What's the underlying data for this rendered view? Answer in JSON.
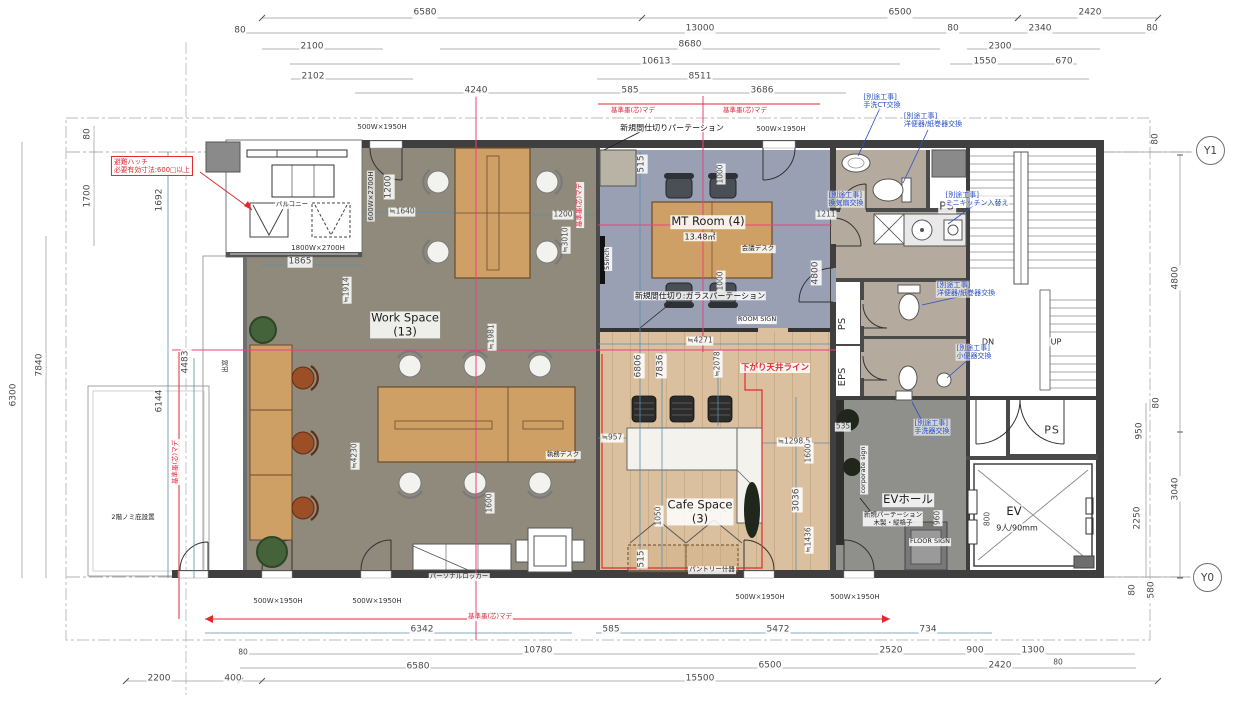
{
  "grid": {
    "y1": "Y1",
    "y0": "Y0"
  },
  "labels": {
    "dims_top": [
      {
        "t": "6580",
        "x": 425,
        "y": 13,
        "c": "dim"
      },
      {
        "t": "13000",
        "x": 700,
        "y": 29,
        "c": "dim"
      },
      {
        "t": "6500",
        "x": 900,
        "y": 13,
        "c": "dim"
      },
      {
        "t": "2420",
        "x": 1090,
        "y": 13,
        "c": "dim"
      },
      {
        "t": "80",
        "x": 240,
        "y": 31,
        "c": "dim"
      },
      {
        "t": "80",
        "x": 953,
        "y": 29,
        "c": "dim"
      },
      {
        "t": "2340",
        "x": 1040,
        "y": 29,
        "c": "dim"
      },
      {
        "t": "80",
        "x": 1152,
        "y": 29,
        "c": "dim"
      },
      {
        "t": "2100",
        "x": 312,
        "y": 47,
        "c": "dim"
      },
      {
        "t": "8680",
        "x": 690,
        "y": 45,
        "c": "dim"
      },
      {
        "t": "2300",
        "x": 1000,
        "y": 47,
        "c": "dim"
      },
      {
        "t": "10613",
        "x": 656,
        "y": 62,
        "c": "dim"
      },
      {
        "t": "1550",
        "x": 985,
        "y": 62,
        "c": "dim"
      },
      {
        "t": "670",
        "x": 1064,
        "y": 62,
        "c": "dim"
      },
      {
        "t": "2102",
        "x": 313,
        "y": 77,
        "c": "dim"
      },
      {
        "t": "8511",
        "x": 700,
        "y": 77,
        "c": "dim"
      },
      {
        "t": "4240",
        "x": 476,
        "y": 91,
        "c": "dim"
      },
      {
        "t": "585",
        "x": 630,
        "y": 91,
        "c": "dim"
      },
      {
        "t": "3686",
        "x": 762,
        "y": 91,
        "c": "dim"
      }
    ],
    "dims_bottom": [
      {
        "t": "6342",
        "x": 422,
        "y": 630,
        "c": "dim"
      },
      {
        "t": "585",
        "x": 611,
        "y": 630,
        "c": "dim"
      },
      {
        "t": "5472",
        "x": 778,
        "y": 630,
        "c": "dim"
      },
      {
        "t": "734",
        "x": 928,
        "y": 630,
        "c": "dim"
      },
      {
        "t": "10780",
        "x": 538,
        "y": 651,
        "c": "dim"
      },
      {
        "t": "2520",
        "x": 891,
        "y": 651,
        "c": "dim"
      },
      {
        "t": "900",
        "x": 975,
        "y": 651,
        "c": "dim"
      },
      {
        "t": "1300",
        "x": 1033,
        "y": 651,
        "c": "dim"
      },
      {
        "t": "80",
        "x": 243,
        "y": 653,
        "c": "dimS"
      },
      {
        "t": "80",
        "x": 1058,
        "y": 663,
        "c": "dimS"
      },
      {
        "t": "6580",
        "x": 418,
        "y": 667,
        "c": "dim"
      },
      {
        "t": "6500",
        "x": 770,
        "y": 666,
        "c": "dim"
      },
      {
        "t": "2420",
        "x": 1000,
        "y": 666,
        "c": "dim"
      },
      {
        "t": "2200",
        "x": 159,
        "y": 679,
        "c": "dim"
      },
      {
        "t": "400",
        "x": 233,
        "y": 679,
        "c": "dim"
      },
      {
        "t": "15500",
        "x": 700,
        "y": 679,
        "c": "dim"
      }
    ],
    "dims_left": [
      {
        "t": "80",
        "x": 88,
        "y": 134,
        "c": "dimv"
      },
      {
        "t": "1700",
        "x": 88,
        "y": 196,
        "c": "dimv"
      },
      {
        "t": "7840",
        "x": 40,
        "y": 365,
        "c": "dimv"
      },
      {
        "t": "6300",
        "x": 14,
        "y": 395,
        "c": "dimv"
      }
    ],
    "dims_right": [
      {
        "t": "80",
        "x": 1156,
        "y": 139,
        "c": "dimv"
      },
      {
        "t": "4800",
        "x": 1176,
        "y": 278,
        "c": "dimv"
      },
      {
        "t": "80",
        "x": 1157,
        "y": 403,
        "c": "dimv"
      },
      {
        "t": "950",
        "x": 1140,
        "y": 431,
        "c": "dimv"
      },
      {
        "t": "3040",
        "x": 1176,
        "y": 489,
        "c": "dimv"
      },
      {
        "t": "2250",
        "x": 1138,
        "y": 518,
        "c": "dimv"
      },
      {
        "t": "80",
        "x": 1133,
        "y": 590,
        "c": "dimv"
      },
      {
        "t": "580",
        "x": 1152,
        "y": 590,
        "c": "dimv"
      }
    ],
    "dims_interior": [
      {
        "t": "1692",
        "x": 160,
        "y": 200,
        "c": "dimv"
      },
      {
        "t": "1865",
        "x": 300,
        "y": 262,
        "c": "dim"
      },
      {
        "t": "1200",
        "x": 389,
        "y": 187,
        "c": "dimv"
      },
      {
        "t": "1200",
        "x": 563,
        "y": 215,
        "c": "dimS"
      },
      {
        "t": "≒1640",
        "x": 402,
        "y": 212,
        "c": "dimS"
      },
      {
        "t": "≒3010",
        "x": 566,
        "y": 240,
        "c": "dimSv"
      },
      {
        "t": "≒1914",
        "x": 347,
        "y": 290,
        "c": "dimSv"
      },
      {
        "t": "≒1981",
        "x": 492,
        "y": 337,
        "c": "dimSv"
      },
      {
        "t": "515",
        "x": 642,
        "y": 164,
        "c": "dimv"
      },
      {
        "t": "1000",
        "x": 721,
        "y": 174,
        "c": "dimSv"
      },
      {
        "t": "1000",
        "x": 721,
        "y": 281,
        "c": "dimSv"
      },
      {
        "t": "1211",
        "x": 826,
        "y": 215,
        "c": "dimS"
      },
      {
        "t": "4800",
        "x": 816,
        "y": 273,
        "c": "dimv"
      },
      {
        "t": "6806",
        "x": 639,
        "y": 366,
        "c": "dimv"
      },
      {
        "t": "7836",
        "x": 661,
        "y": 366,
        "c": "dimv"
      },
      {
        "t": "≒2078",
        "x": 718,
        "y": 364,
        "c": "dimSv"
      },
      {
        "t": "≒4271",
        "x": 700,
        "y": 341,
        "c": "dimS"
      },
      {
        "t": "≒957",
        "x": 612,
        "y": 438,
        "c": "dimS"
      },
      {
        "t": "≒1298.5",
        "x": 794,
        "y": 442,
        "c": "dimS"
      },
      {
        "t": "3036",
        "x": 797,
        "y": 500,
        "c": "dimv"
      },
      {
        "t": "1600",
        "x": 809,
        "y": 453,
        "c": "dimSv"
      },
      {
        "t": "≒1436",
        "x": 809,
        "y": 540,
        "c": "dimSv"
      },
      {
        "t": "535",
        "x": 843,
        "y": 427,
        "c": "dimS"
      },
      {
        "t": "515",
        "x": 642,
        "y": 559,
        "c": "dimv"
      },
      {
        "t": "1050",
        "x": 659,
        "y": 516,
        "c": "dimSv"
      },
      {
        "t": "≒4230",
        "x": 355,
        "y": 456,
        "c": "dimSv"
      },
      {
        "t": "1600",
        "x": 490,
        "y": 503,
        "c": "dimSv"
      },
      {
        "t": "6144",
        "x": 160,
        "y": 401,
        "c": "dimv"
      },
      {
        "t": "4483",
        "x": 186,
        "y": 362,
        "c": "dimv"
      },
      {
        "t": "960",
        "x": 938,
        "y": 518,
        "c": "dimSv"
      },
      {
        "t": "800",
        "x": 988,
        "y": 519,
        "c": "dimSv"
      }
    ],
    "rooms": [
      {
        "t": "Work Space\n(13)",
        "x": 405,
        "y": 325,
        "c": "room",
        "n": "room-label-work-space"
      },
      {
        "t": "MT Room (4)",
        "x": 708,
        "y": 222,
        "c": "room",
        "n": "room-label-mt-room"
      },
      {
        "t": "13.48㎡",
        "x": 700,
        "y": 237,
        "c": "sub",
        "n": "mt-room-area"
      },
      {
        "t": "Cafe Space\n(3)",
        "x": 700,
        "y": 512,
        "c": "room",
        "n": "room-label-cafe-space"
      },
      {
        "t": "EVホール",
        "x": 908,
        "y": 500,
        "c": "room",
        "n": "room-label-ev-hall"
      },
      {
        "t": "EV",
        "x": 1014,
        "y": 512,
        "c": "room",
        "n": "room-label-ev"
      },
      {
        "t": "9人/90mm",
        "x": 1017,
        "y": 528,
        "c": "sub",
        "n": "ev-capacity"
      },
      {
        "t": "PS",
        "x": 947,
        "y": 207,
        "c": "ps",
        "n": "room-label-ps"
      },
      {
        "t": "PS",
        "x": 843,
        "y": 324,
        "c": "psv",
        "n": "room-label-ps"
      },
      {
        "t": "EPS",
        "x": 843,
        "y": 377,
        "c": "psv",
        "n": "room-label-eps"
      },
      {
        "t": "PS",
        "x": 1052,
        "y": 431,
        "c": "ps",
        "n": "room-label-ps"
      },
      {
        "t": "DN",
        "x": 988,
        "y": 342,
        "c": "sub",
        "n": "stair-dn"
      },
      {
        "t": "UP",
        "x": 1056,
        "y": 342,
        "c": "sub",
        "n": "stair-up"
      },
      {
        "t": "バルコニー",
        "x": 292,
        "y": 205,
        "c": "tiny",
        "n": "room-label-balcony"
      },
      {
        "t": "出窓",
        "x": 226,
        "y": 366,
        "c": "tinyv",
        "n": "bay-window-label"
      },
      {
        "t": "2階ノミ庇設置",
        "x": 133,
        "y": 518,
        "c": "tiny",
        "n": "eave-note"
      }
    ],
    "notes_black": [
      {
        "t": "新規間仕切りパーテーション",
        "x": 672,
        "y": 128,
        "c": "note",
        "n": "note-new-partition"
      },
      {
        "t": "新規間仕切り:ガラスパーテーション",
        "x": 700,
        "y": 296,
        "c": "note",
        "n": "note-glass-partition"
      },
      {
        "t": "新規パーテーション\n木製・縦格子",
        "x": 893,
        "y": 519,
        "c": "tiny",
        "n": "note-wood-partition"
      },
      {
        "t": "会議デスク",
        "x": 758,
        "y": 249,
        "c": "tiny",
        "n": "furniture-label-meeting-desk"
      },
      {
        "t": "執務デスク",
        "x": 563,
        "y": 455,
        "c": "tiny",
        "n": "furniture-label-work-desk"
      },
      {
        "t": "パーソナルロッカー",
        "x": 459,
        "y": 577,
        "c": "tiny",
        "n": "furniture-label-personal-locker"
      },
      {
        "t": "パントリー什器",
        "x": 712,
        "y": 570,
        "c": "tiny",
        "n": "furniture-label-pantry"
      },
      {
        "t": "ROOM SIGN",
        "x": 757,
        "y": 320,
        "c": "tiny",
        "n": "room-sign-label"
      },
      {
        "t": "FLOOR SIGN",
        "x": 930,
        "y": 542,
        "c": "tiny",
        "n": "floor-sign-label"
      },
      {
        "t": "55inch",
        "x": 608,
        "y": 259,
        "c": "tinyv",
        "n": "display-55inch-label"
      },
      {
        "t": "corporate sign",
        "x": 864,
        "y": 470,
        "c": "tinyv",
        "n": "corporate-sign-label"
      }
    ],
    "notes_red": [
      {
        "t": "避難ハッチ\n必要有効寸法:600□以上",
        "x": 152,
        "y": 166,
        "c": "redbox",
        "n": "note-escape-hatch"
      },
      {
        "t": "下がり天井ライン",
        "x": 775,
        "y": 368,
        "c": "redlabel",
        "n": "note-dropped-ceiling-line"
      },
      {
        "t": "基準墨(芯)マデ",
        "x": 633,
        "y": 111,
        "c": "red",
        "n": "note-reference-line"
      },
      {
        "t": "基準墨(芯)マデ",
        "x": 745,
        "y": 111,
        "c": "red",
        "n": "note-reference-line"
      },
      {
        "t": "基準墨(芯)マデ",
        "x": 580,
        "y": 205,
        "c": "redv",
        "n": "note-reference-line"
      },
      {
        "t": "基準墨(芯)マデ",
        "x": 176,
        "y": 462,
        "c": "redv",
        "n": "note-reference-line"
      },
      {
        "t": "基準墨(芯)マデ",
        "x": 490,
        "y": 617,
        "c": "red",
        "n": "note-reference-line"
      }
    ],
    "notes_blue": [
      {
        "t": "[別途工事]\n手洗CT交換",
        "x": 882,
        "y": 101,
        "c": "blue",
        "n": "note-separate-work-ct"
      },
      {
        "t": "[別途工事]\n洋便器/紙巻器交換",
        "x": 933,
        "y": 120,
        "c": "blue",
        "n": "note-separate-work-toilet"
      },
      {
        "t": "[別途工事]\n換気扇交換",
        "x": 846,
        "y": 199,
        "c": "blue",
        "n": "note-separate-work-fan"
      },
      {
        "t": "[別途工事]\nミニキッチン入替え",
        "x": 977,
        "y": 199,
        "c": "blue",
        "n": "note-separate-work-kitchen"
      },
      {
        "t": "[別途工事]\n洋便器/紙巻器交換",
        "x": 966,
        "y": 289,
        "c": "blue",
        "n": "note-separate-work-toilet2"
      },
      {
        "t": "[別途工事]\n小便器交換",
        "x": 974,
        "y": 352,
        "c": "blue",
        "n": "note-separate-work-urinal"
      },
      {
        "t": "[別途工事]\n手洗器交換",
        "x": 932,
        "y": 427,
        "c": "blue",
        "n": "note-separate-work-basin"
      }
    ],
    "door_labels": [
      {
        "t": "500W×1950H",
        "x": 382,
        "y": 127,
        "c": "door",
        "n": "door-size-label"
      },
      {
        "t": "500W×1950H",
        "x": 781,
        "y": 129,
        "c": "door",
        "n": "door-size-label"
      },
      {
        "t": "600W×2700H",
        "x": 371,
        "y": 196,
        "c": "door tinyv",
        "n": "door-size-label"
      },
      {
        "t": "1800W×2700H",
        "x": 318,
        "y": 248,
        "c": "door",
        "n": "door-size-label"
      },
      {
        "t": "500W×1950H",
        "x": 278,
        "y": 601,
        "c": "door",
        "n": "door-size-label"
      },
      {
        "t": "500W×1950H",
        "x": 377,
        "y": 601,
        "c": "door",
        "n": "door-size-label"
      },
      {
        "t": "500W×1950H",
        "x": 760,
        "y": 597,
        "c": "door",
        "n": "door-size-label"
      },
      {
        "t": "500W×1950H",
        "x": 855,
        "y": 597,
        "c": "door",
        "n": "door-size-label"
      }
    ]
  }
}
